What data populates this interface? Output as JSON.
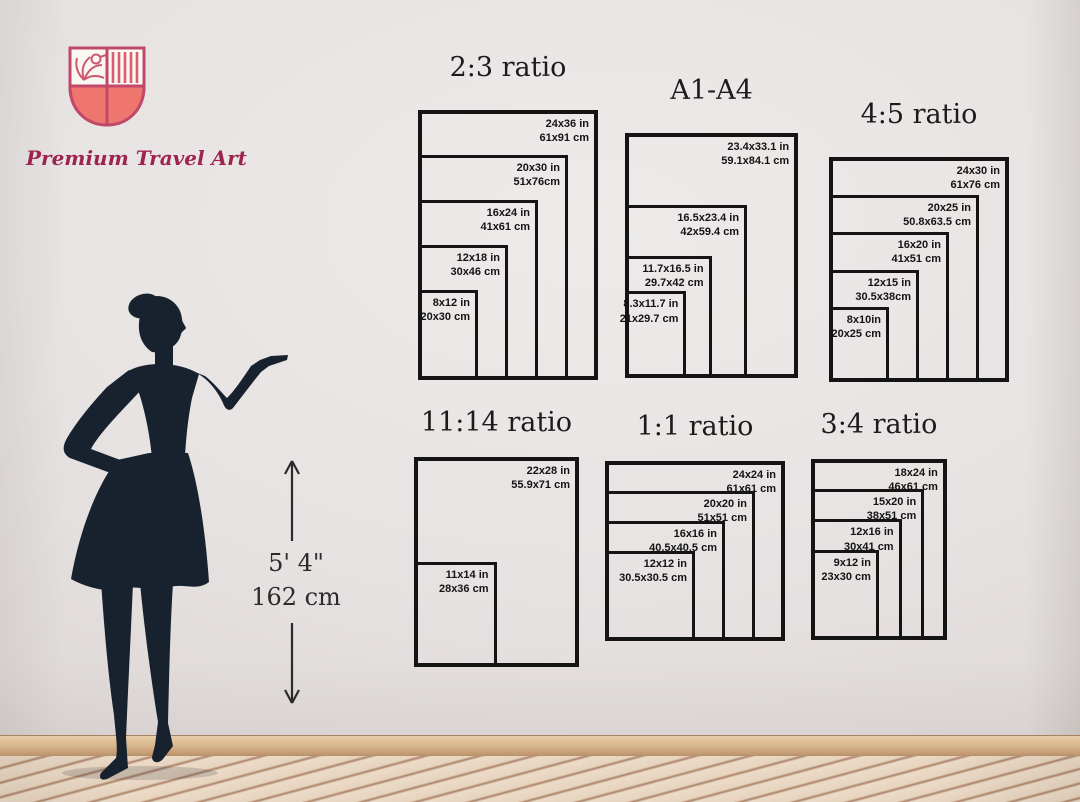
{
  "brand": {
    "name": "Premium Travel Art"
  },
  "icons": {
    "logo": "shield-crest-bird-palm",
    "figure": "woman-silhouette",
    "marker_up": "arrow-up",
    "marker_down": "arrow-down"
  },
  "colors": {
    "brand_text": "#9e2450",
    "shield_outline": "#c2486a",
    "shield_fill": "#ee766e",
    "silhouette": "#18222e",
    "chart_line": "#141414"
  },
  "height_marker": {
    "feet": "5' 4\"",
    "cm": "162 cm"
  },
  "size_charts": [
    {
      "id": "2-3-ratio",
      "title": "2:3 ratio",
      "sizes": [
        {
          "inches": "24x36 in",
          "cm": "61x91 cm",
          "w": 24,
          "h": 36
        },
        {
          "inches": "20x30 in",
          "cm": "51x76cm",
          "w": 20,
          "h": 30
        },
        {
          "inches": "16x24 in",
          "cm": "41x61 cm",
          "w": 16,
          "h": 24
        },
        {
          "inches": "12x18 in",
          "cm": "30x46 cm",
          "w": 12,
          "h": 18
        },
        {
          "inches": "8x12 in",
          "cm": "20x30 cm",
          "w": 8,
          "h": 12
        }
      ]
    },
    {
      "id": "a1-a4",
      "title": "A1-A4",
      "sizes": [
        {
          "inches": "23.4x33.1 in",
          "cm": "59.1x84.1 cm",
          "w": 23.4,
          "h": 33.1
        },
        {
          "inches": "16.5x23.4 in",
          "cm": "42x59.4 cm",
          "w": 16.5,
          "h": 23.4
        },
        {
          "inches": "11.7x16.5 in",
          "cm": "29.7x42 cm",
          "w": 11.7,
          "h": 16.5
        },
        {
          "inches": "8.3x11.7 in",
          "cm": "21x29.7 cm",
          "w": 8.3,
          "h": 11.7
        }
      ]
    },
    {
      "id": "4-5-ratio",
      "title": "4:5 ratio",
      "sizes": [
        {
          "inches": "24x30 in",
          "cm": "61x76 cm",
          "w": 24,
          "h": 30
        },
        {
          "inches": "20x25 in",
          "cm": "50.8x63.5 cm",
          "w": 20,
          "h": 25
        },
        {
          "inches": "16x20 in",
          "cm": "41x51 cm",
          "w": 16,
          "h": 20
        },
        {
          "inches": "12x15 in",
          "cm": "30.5x38cm",
          "w": 12,
          "h": 15
        },
        {
          "inches": "8x10in",
          "cm": "20x25 cm",
          "w": 8,
          "h": 10
        }
      ]
    },
    {
      "id": "11-14-ratio",
      "title": "11:14 ratio",
      "sizes": [
        {
          "inches": "22x28 in",
          "cm": "55.9x71 cm",
          "w": 22,
          "h": 28
        },
        {
          "inches": "11x14 in",
          "cm": "28x36 cm",
          "w": 11,
          "h": 14
        }
      ]
    },
    {
      "id": "1-1-ratio",
      "title": "1:1 ratio",
      "sizes": [
        {
          "inches": "24x24 in",
          "cm": "61x61 cm",
          "w": 24,
          "h": 24
        },
        {
          "inches": "20x20 in",
          "cm": "51x51 cm",
          "w": 20,
          "h": 20
        },
        {
          "inches": "16x16 in",
          "cm": "40.5x40.5 cm",
          "w": 16,
          "h": 16
        },
        {
          "inches": "12x12 in",
          "cm": "30.5x30.5 cm",
          "w": 12,
          "h": 12
        }
      ]
    },
    {
      "id": "3-4-ratio",
      "title": "3:4 ratio",
      "sizes": [
        {
          "inches": "18x24 in",
          "cm": "46x61 cm",
          "w": 18,
          "h": 24
        },
        {
          "inches": "15x20 in",
          "cm": "38x51 cm",
          "w": 15,
          "h": 20
        },
        {
          "inches": "12x16 in",
          "cm": "30x41 cm",
          "w": 12,
          "h": 16
        },
        {
          "inches": "9x12 in",
          "cm": "23x30 cm",
          "w": 9,
          "h": 12
        }
      ]
    }
  ]
}
